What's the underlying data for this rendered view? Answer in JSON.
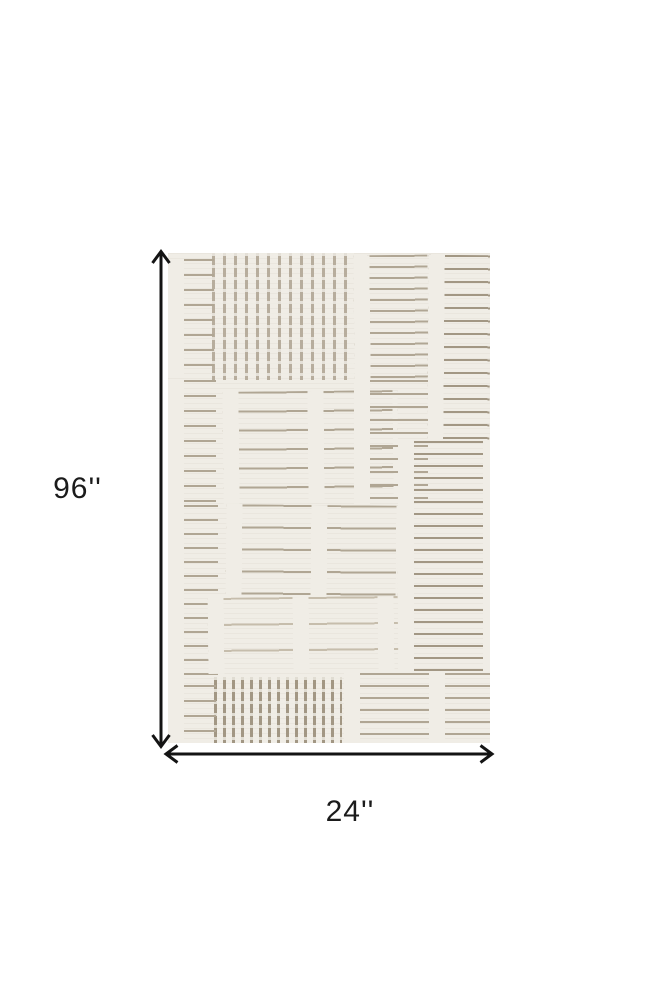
{
  "figure": {
    "height_label": "96''",
    "width_label": "24''"
  },
  "icons": {
    "height_arrow": "double-headed-vertical-arrow",
    "width_arrow": "double-headed-horizontal-arrow"
  },
  "colors": {
    "page_bg": "#ffffff",
    "arrow_color": "#141414",
    "label_color": "#1b1b1b",
    "rug_base": "#f0ede6",
    "rug_line": "#b0a694",
    "rug_line_dark": "#a29784",
    "rug_line_light": "#c6bdac",
    "rug_stripe": "#b7ad9d"
  }
}
